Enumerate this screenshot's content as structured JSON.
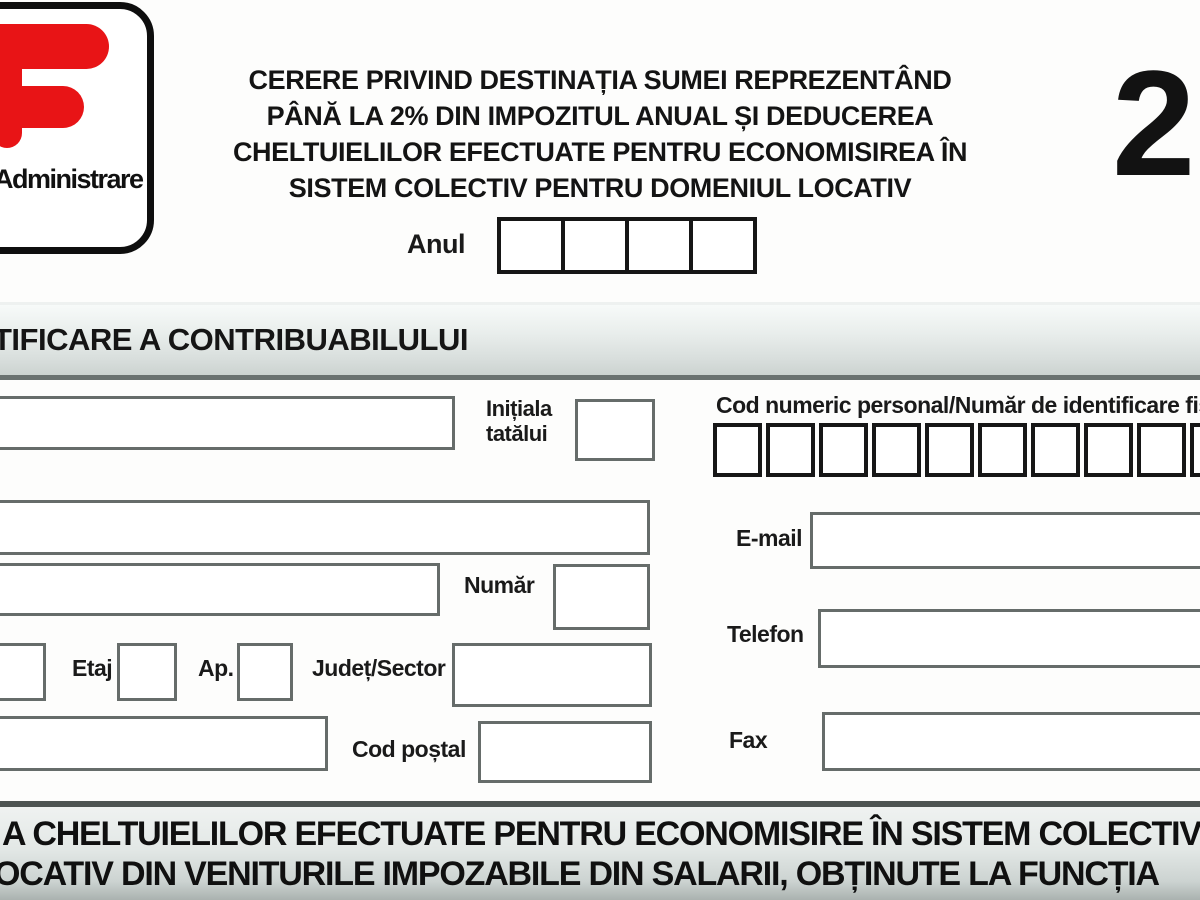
{
  "logo": {
    "icon": "anaf-flag-icon",
    "caption": "Administrare"
  },
  "header": {
    "title_lines": [
      "CERERE PRIVIND DESTINAȚIA SUMEI REPREZENTÂND",
      "PÂNĂ LA 2% DIN IMPOZITUL ANUAL ȘI DEDUCEREA",
      "CHELTUIELILOR EFECTUATE PENTRU ECONOMISIREA ÎN",
      "SISTEM COLECTIV PENTRU DOMENIUL LOCATIV"
    ],
    "form_number": "2",
    "year_label": "Anul"
  },
  "sections": {
    "identification_title": "TIFICARE A CONTRIBUABILULUI",
    "deduction_line1": "A CHELTUIELILOR EFECTUATE PENTRU ECONOMISIRE ÎN SISTEM COLECTIV",
    "deduction_line2": "OCATIV DIN VENITURILE IMPOZABILE DIN SALARII, OBȚINUTE LA FUNCȚIA"
  },
  "fields": {
    "initiala_line1": "Inițiala",
    "initiala_line2": "tatălui",
    "cnp_label": "Cod numeric personal/Număr de identificare fis",
    "email_label": "E-mail",
    "telefon_label": "Telefon",
    "fax_label": "Fax",
    "numar_label": "Număr",
    "etaj_label": "Etaj",
    "ap_label": "Ap.",
    "judet_label": "Județ/Sector",
    "cod_postal_label": "Cod poștal"
  },
  "counts": {
    "year_cells": 4,
    "cnp_cells": 10
  },
  "colors": {
    "logo_red": "#e81416",
    "field_border_gray": "#666c6a",
    "cell_border_black": "#161616",
    "bar_gradient_light": "#eff2f1",
    "bar_gradient_dark": "#aab2af"
  }
}
